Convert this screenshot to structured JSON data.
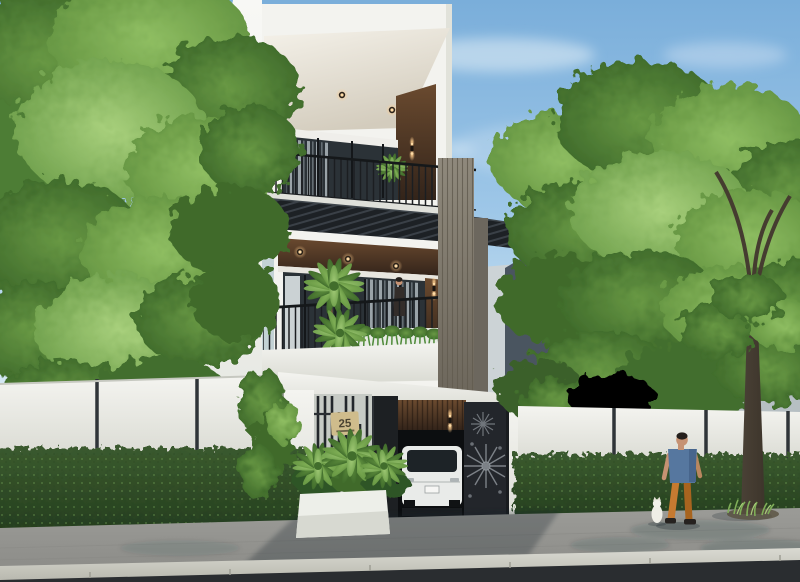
{
  "house": {
    "number_label": "25"
  },
  "palette": {
    "sky_top": "#7aaeda",
    "sky_mid": "#9ec7e8",
    "sky_bottom": "#d9ebf5",
    "cloud": "#eef5fa",
    "foliage_light": "#8fbe62",
    "foliage_mid": "#689844",
    "foliage_dark": "#416d2c",
    "hedge_light": "#5f8f4a",
    "hedge_mid": "#3a5a2e",
    "hedge_dark": "#233b1d",
    "wall_white": "#f4f4f0",
    "wall_shadow": "#d9dad2",
    "wood_mid": "#6a4a2f",
    "wood_dark": "#33241a",
    "screen_gray": "#8f897c",
    "glass": "#2b3237",
    "plate_bg": "#cfbc8c",
    "plate_text": "#4b4332",
    "car_body": "#e9ebe9",
    "sidewalk": "#9b9b97",
    "curb": "#dadad2",
    "road": "#2a2d30",
    "trunk": "#3d352b",
    "skin": "#c69273",
    "shirt": "#56779f",
    "pants": "#c67a31",
    "building_dark": "#4a5560",
    "building_light": "#ccd3d6",
    "light_warm": "#ffcd8d"
  }
}
